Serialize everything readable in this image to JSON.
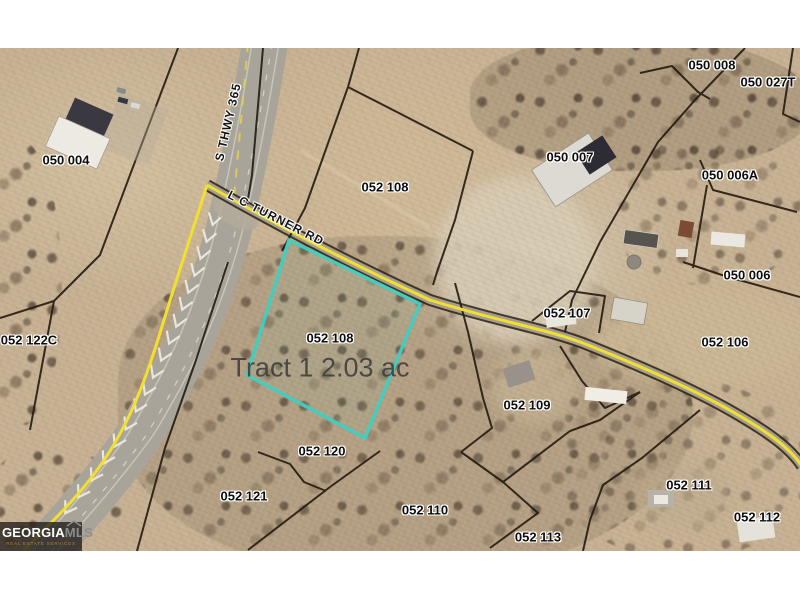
{
  "map": {
    "colors": {
      "highlight": "#3fd0c2",
      "road_overlay": "#f2df2e",
      "boundary": "#231a10",
      "label": "#0d0d0d",
      "halo": "#ffffff",
      "tract_text": "#3a3a3a"
    },
    "tract_label": {
      "text": "Tract 1 2.03 ac",
      "x": 320,
      "y": 320
    },
    "road_labels": [
      {
        "id": "s-hwy-365",
        "text": "S THWY 365",
        "x": 228,
        "y": 74,
        "rotation": -77
      },
      {
        "id": "lc-turner-rd",
        "text": "L C TURNER RD",
        "x": 276,
        "y": 170,
        "rotation": 27
      }
    ],
    "parcel_labels": [
      {
        "id": "050-004",
        "text": "050 004",
        "x": 66,
        "y": 112
      },
      {
        "id": "050-008",
        "text": "050 008",
        "x": 712,
        "y": 17
      },
      {
        "id": "050-027T",
        "text": "050 027T",
        "x": 768,
        "y": 34
      },
      {
        "id": "050-007",
        "text": "050 007",
        "x": 570,
        "y": 109
      },
      {
        "id": "050-006A",
        "text": "050 006A",
        "x": 730,
        "y": 127
      },
      {
        "id": "050-006",
        "text": "050 006",
        "x": 747,
        "y": 227
      },
      {
        "id": "052-108-north",
        "text": "052 108",
        "x": 385,
        "y": 139
      },
      {
        "id": "052-107",
        "text": "052 107",
        "x": 567,
        "y": 265
      },
      {
        "id": "052-106",
        "text": "052 106",
        "x": 725,
        "y": 294
      },
      {
        "id": "052-122C",
        "text": "052 122C",
        "x": 29,
        "y": 292
      },
      {
        "id": "052-108-tract",
        "text": "052 108",
        "x": 330,
        "y": 290
      },
      {
        "id": "052-109",
        "text": "052 109",
        "x": 527,
        "y": 357
      },
      {
        "id": "052-120",
        "text": "052 120",
        "x": 322,
        "y": 403
      },
      {
        "id": "052-121",
        "text": "052 121",
        "x": 244,
        "y": 448
      },
      {
        "id": "052-110",
        "text": "052 110",
        "x": 425,
        "y": 462
      },
      {
        "id": "052-113",
        "text": "052 113",
        "x": 538,
        "y": 489
      },
      {
        "id": "052-111",
        "text": "052 111",
        "x": 689,
        "y": 437
      },
      {
        "id": "052-112",
        "text": "052 112",
        "x": 757,
        "y": 469
      }
    ],
    "attribution": {
      "part1": "GEORGIA",
      "part2": "MLS",
      "tagline": "REAL ESTATE SERVICES"
    }
  }
}
